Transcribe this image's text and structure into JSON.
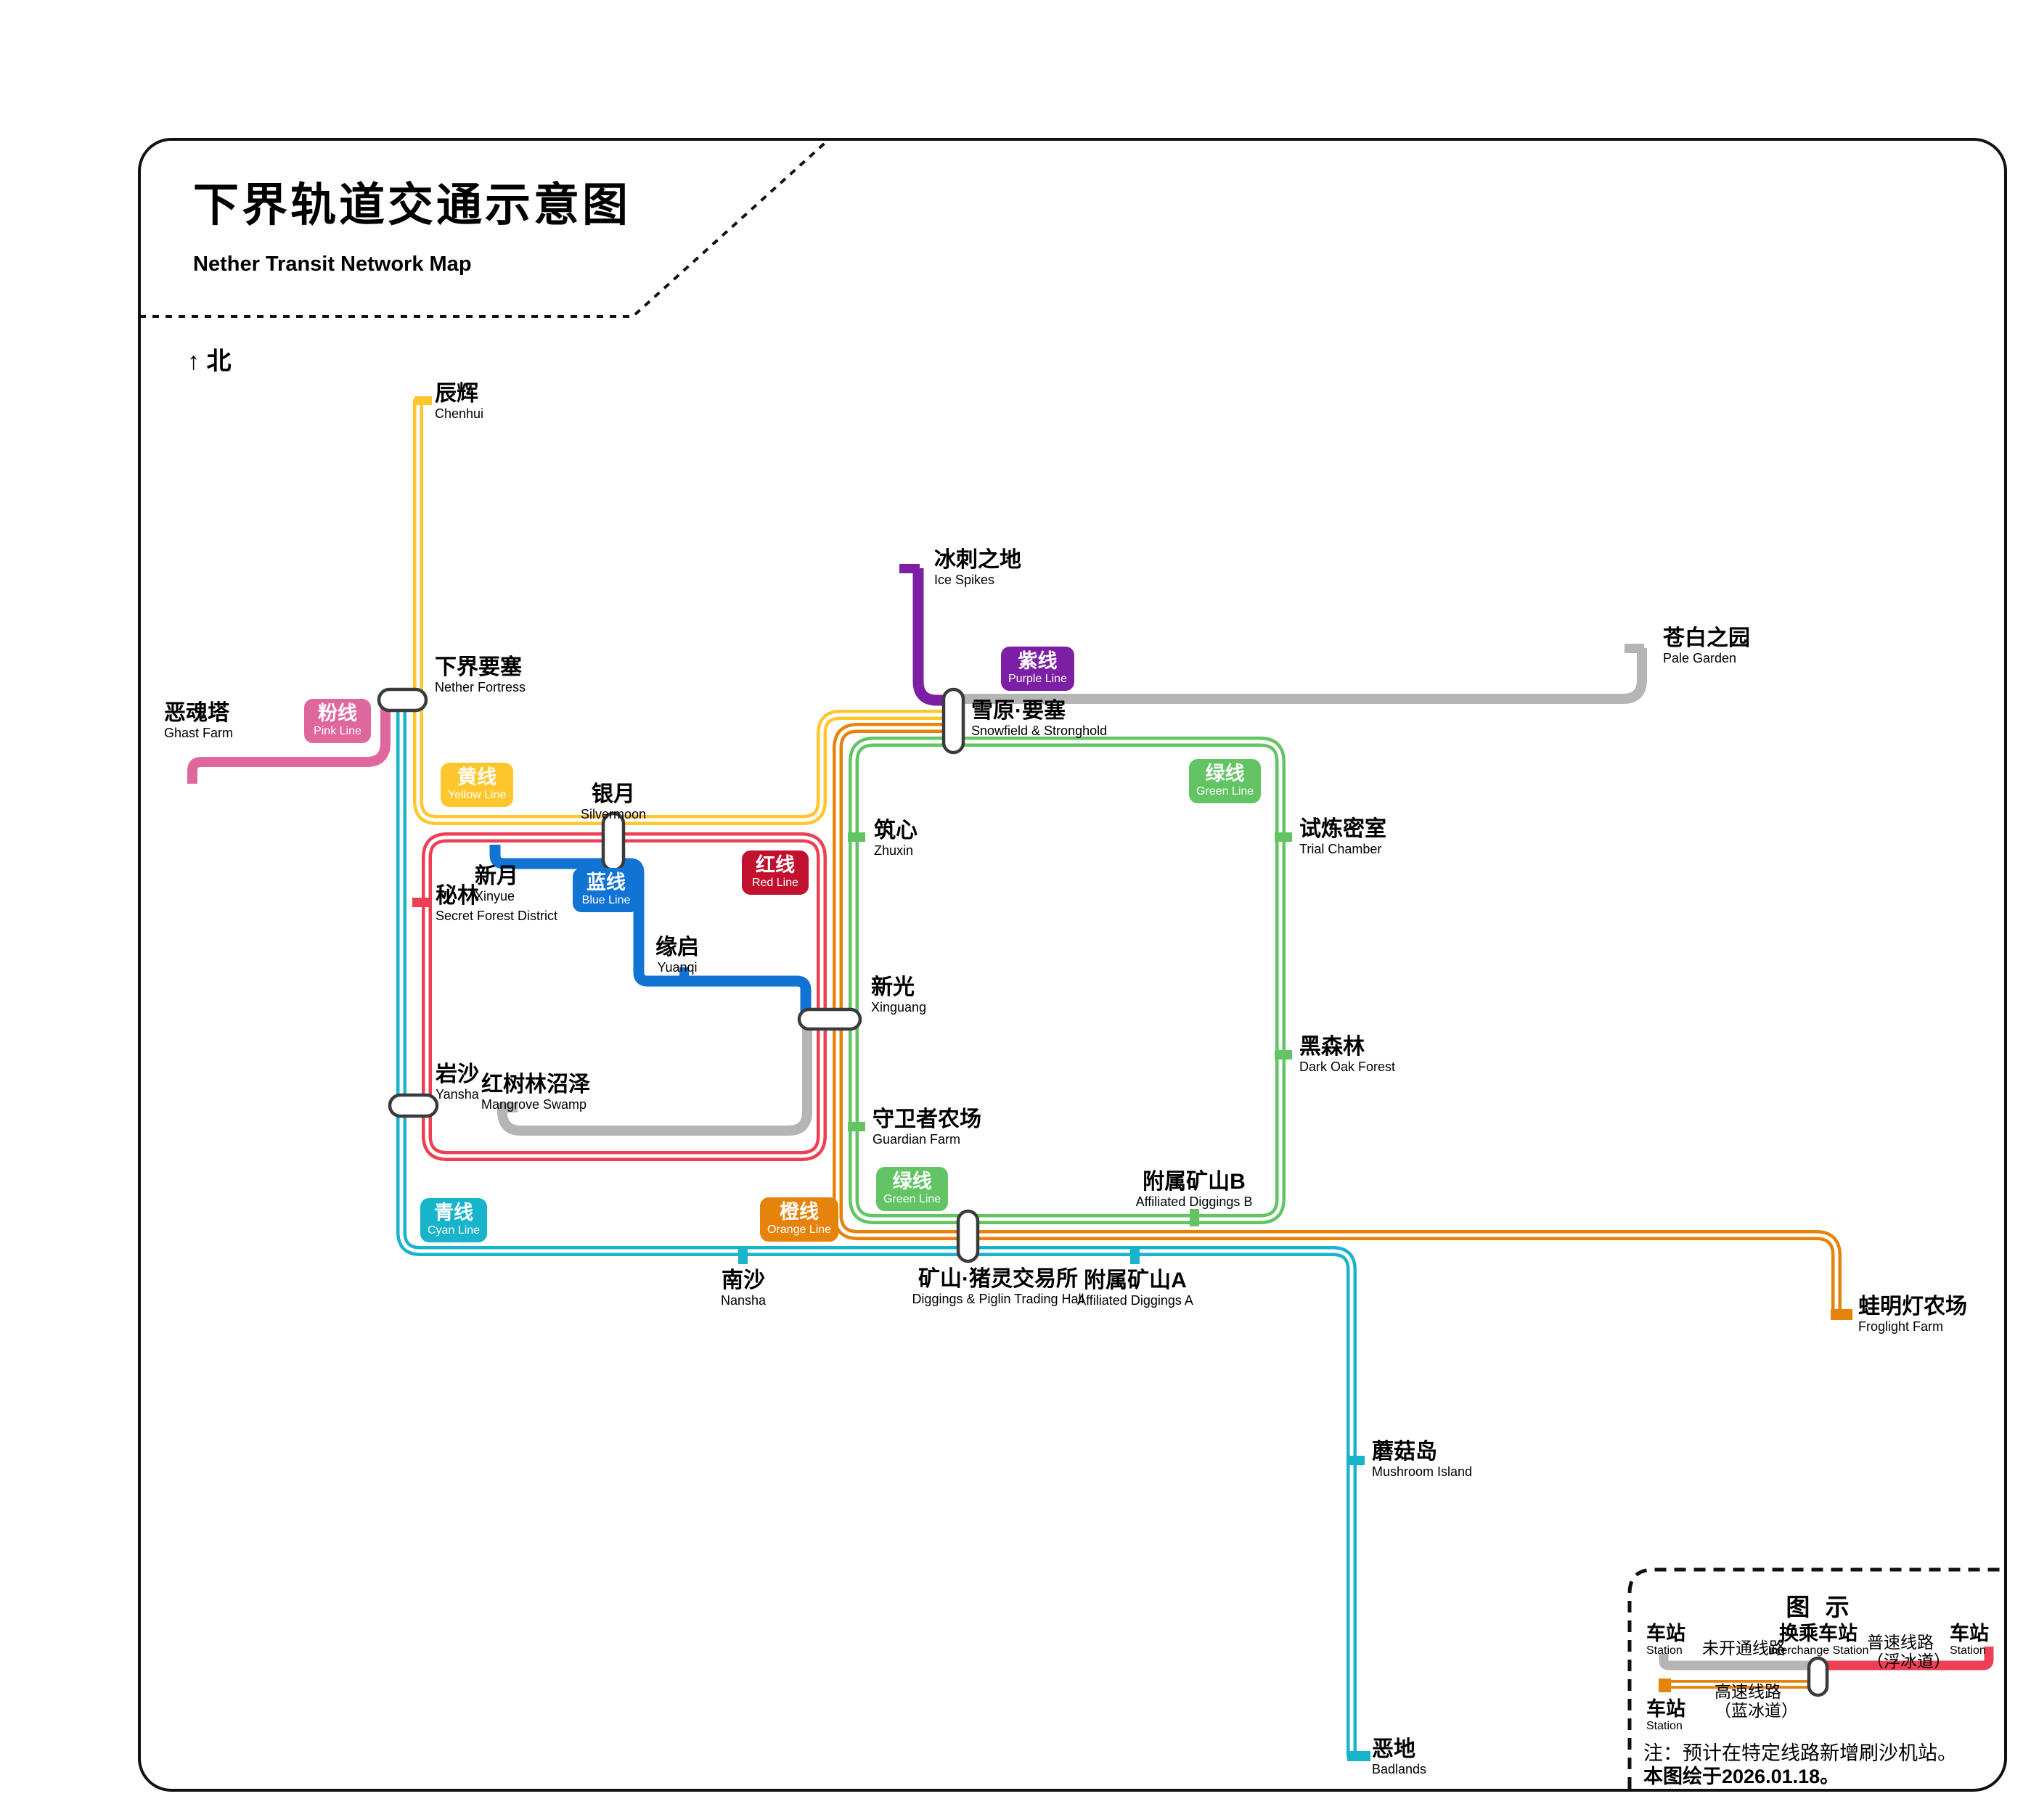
{
  "header": {
    "title": "下界轨道交通示意图",
    "subtitle": "Nether Transit Network Map",
    "north_label": "↑ 北"
  },
  "lines": {
    "pink": {
      "zh": "粉线",
      "en": "Pink Line",
      "color": "#E0679E"
    },
    "yellow": {
      "zh": "黄线",
      "en": "Yellow Line",
      "color": "#FFC62E"
    },
    "blue": {
      "zh": "蓝线",
      "en": "Blue Line",
      "color": "#1173D4"
    },
    "red": {
      "zh": "红线",
      "en": "Red Line",
      "color": "#EE3F55",
      "badge_color": "#C2112F"
    },
    "purple": {
      "zh": "紫线",
      "en": "Purple Line",
      "color": "#7D1FA5"
    },
    "green": {
      "zh": "绿线",
      "en": "Green Line",
      "color": "#62C462"
    },
    "cyan": {
      "zh": "青线",
      "en": "Cyan Line",
      "color": "#18B4CB"
    },
    "orange": {
      "zh": "橙线",
      "en": "Orange Line",
      "color": "#E5830B"
    },
    "unopened": {
      "color": "#B5B5B5"
    }
  },
  "stations": {
    "chenhui": {
      "zh": "辰辉",
      "en": "Chenhui"
    },
    "nether_fortress": {
      "zh": "下界要塞",
      "en": "Nether Fortress"
    },
    "ghast_farm": {
      "zh": "恶魂塔",
      "en": "Ghast Farm"
    },
    "ice_spikes": {
      "zh": "冰刺之地",
      "en": "Ice Spikes"
    },
    "snowfield": {
      "zh": "雪原·要塞",
      "en": "Snowfield & Stronghold"
    },
    "pale_garden": {
      "zh": "苍白之园",
      "en": "Pale Garden"
    },
    "silvermoon": {
      "zh": "银月",
      "en": "Silvermoon"
    },
    "zhuxin": {
      "zh": "筑心",
      "en": "Zhuxin"
    },
    "trial_chamber": {
      "zh": "试炼密室",
      "en": "Trial Chamber"
    },
    "xinyue": {
      "zh": "新月",
      "en": "Xinyue"
    },
    "secret_forest": {
      "zh": "秘林",
      "en": "Secret Forest District"
    },
    "yuanqi": {
      "zh": "缘启",
      "en": "Yuanqi"
    },
    "xinguang": {
      "zh": "新光",
      "en": "Xinguang"
    },
    "dark_oak": {
      "zh": "黑森林",
      "en": "Dark Oak Forest"
    },
    "yansha": {
      "zh": "岩沙",
      "en": "Yansha"
    },
    "mangrove": {
      "zh": "红树林沼泽",
      "en": "Mangrove Swamp"
    },
    "guardian": {
      "zh": "守卫者农场",
      "en": "Guardian Farm"
    },
    "diggings_b": {
      "zh": "附属矿山B",
      "en": "Affiliated Diggings B"
    },
    "nansha": {
      "zh": "南沙",
      "en": "Nansha"
    },
    "piglin": {
      "zh": "矿山·猪灵交易所",
      "en": "Diggings & Piglin Trading Hall"
    },
    "diggings_a": {
      "zh": "附属矿山A",
      "en": "Affiliated Diggings A"
    },
    "froglight": {
      "zh": "蛙明灯农场",
      "en": "Froglight Farm"
    },
    "mushroom": {
      "zh": "蘑菇岛",
      "en": "Mushroom Island"
    },
    "badlands": {
      "zh": "恶地",
      "en": "Badlands"
    }
  },
  "legend": {
    "title": "图 示",
    "station": "车站",
    "station_en": "Station",
    "unopened_label": "未开通线路",
    "interchange": "换乘车站",
    "interchange_en": "Interchange Station",
    "normal_line1": "普速线路",
    "normal_line2": "（浮冰道）",
    "high_line1": "高速线路",
    "high_line2": "（蓝冰道）",
    "note": "注：预计在特定线路新增刷沙机站。",
    "date_note": "本图绘于2026.01.18。"
  }
}
